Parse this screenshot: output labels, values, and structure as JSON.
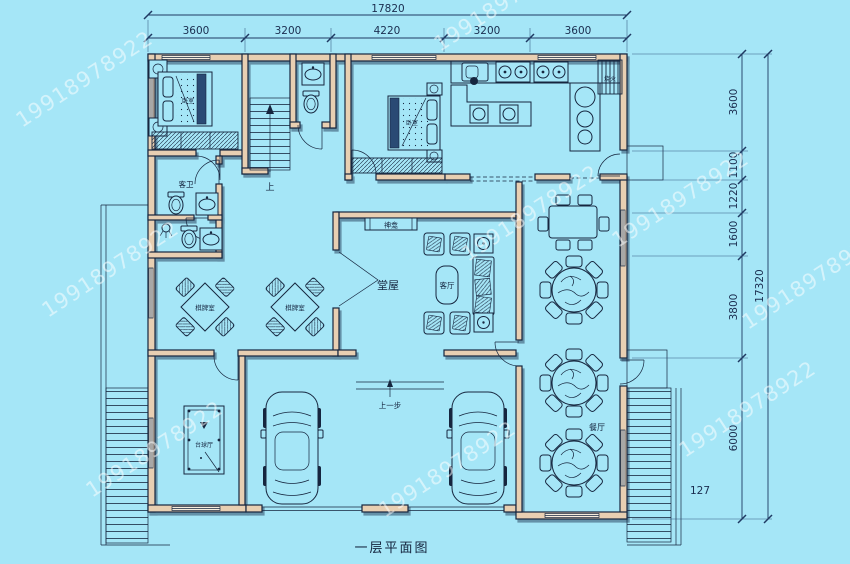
{
  "title": "一层平面图",
  "watermark": {
    "text": "19918978922"
  },
  "colors": {
    "background": "#a5e6f7",
    "wall_fill": "#e8cfb2",
    "line": "#16263f",
    "watermark": "#ffffff"
  },
  "dimensions": {
    "top": {
      "total": "17820",
      "segments": [
        "3600",
        "3200",
        "4220",
        "3200",
        "3600"
      ]
    },
    "right": {
      "total": "17320",
      "segments": [
        "3600",
        "1100",
        "1220",
        "1600",
        "3800",
        "6000"
      ],
      "note": "127"
    }
  },
  "rooms": {
    "bedroom1": "卧室",
    "bedroom2": "卧室",
    "guest_bath": "客卫",
    "shrine": "神龛",
    "main_hall": "堂屋",
    "living_room": "客厅",
    "card_room1": "棋牌室",
    "card_room2": "棋牌室",
    "dining": "餐厅",
    "billiards": "台球厅",
    "stove": "烧火",
    "stairs_up": "上",
    "entry_step": "上一步"
  }
}
